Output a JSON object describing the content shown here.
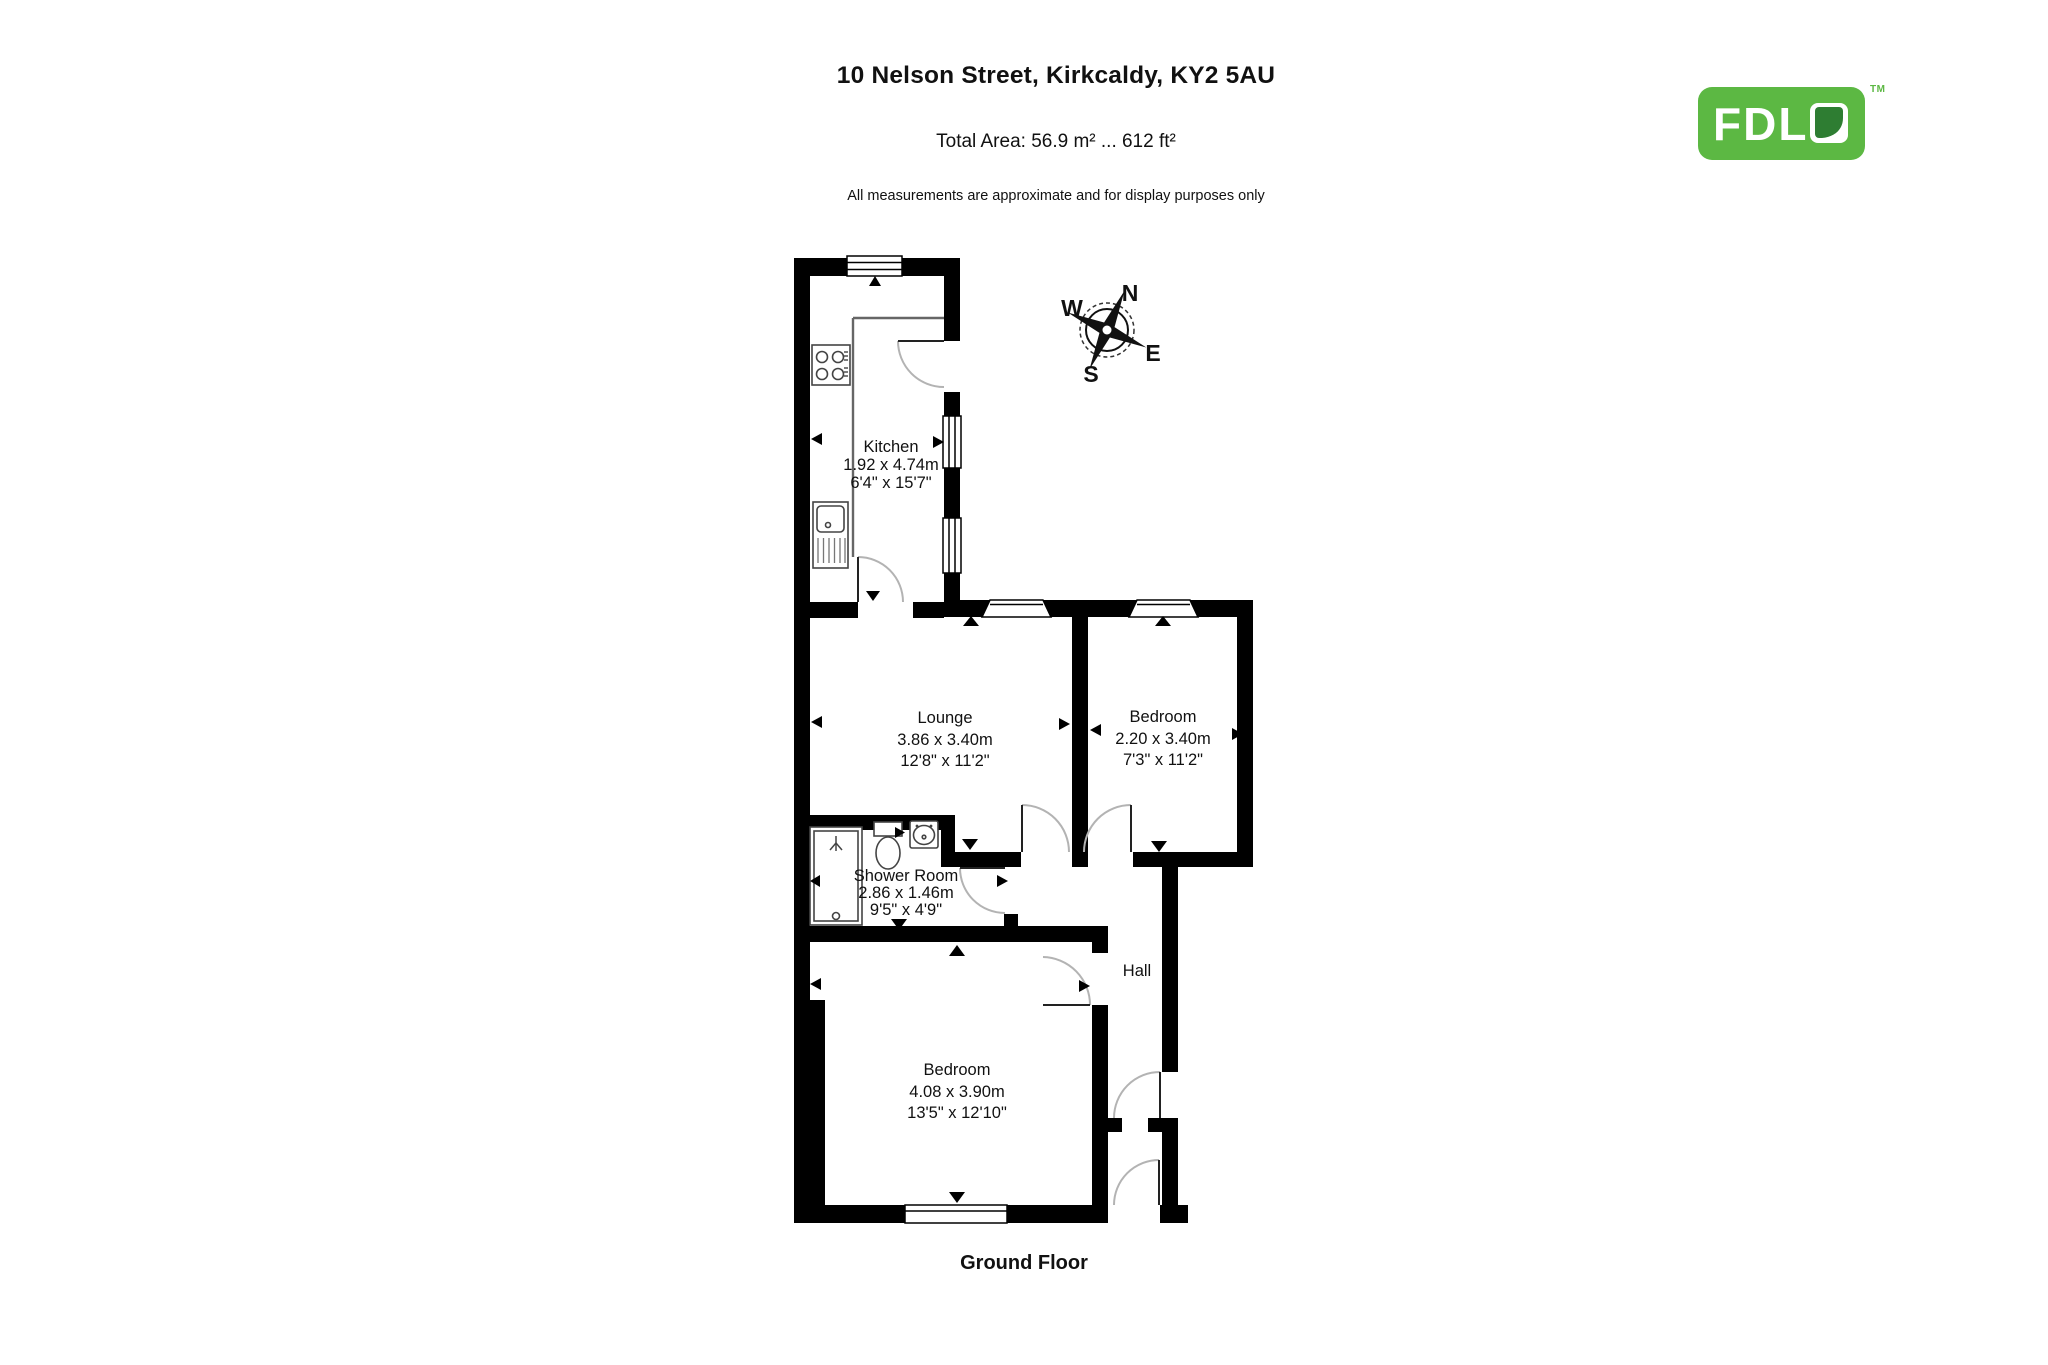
{
  "header": {
    "title": "10 Nelson Street, Kirkcaldy, KY2 5AU",
    "total_area": "Total Area: 56.9 m² ... 612 ft²",
    "disclaimer": "All measurements are approximate and for display purposes only"
  },
  "logo": {
    "text": "FDL",
    "tm": "TM",
    "brand_green": "#5cb843",
    "leaf_green": "#2e7d32"
  },
  "floor": {
    "label": "Ground Floor"
  },
  "compass": {
    "n": "N",
    "e": "E",
    "s": "S",
    "w": "W"
  },
  "rooms": {
    "kitchen": {
      "name": "Kitchen",
      "metric": "1.92 x 4.74m",
      "imperial": "6'4\" x 15'7\""
    },
    "lounge": {
      "name": "Lounge",
      "metric": "3.86 x 3.40m",
      "imperial": "12'8\" x 11'2\""
    },
    "bedroom1": {
      "name": "Bedroom",
      "metric": "2.20 x 3.40m",
      "imperial": "7'3\" x 11'2\""
    },
    "shower": {
      "name": "Shower Room",
      "metric": "2.86 x 1.46m",
      "imperial": "9'5\" x 4'9\""
    },
    "hall": {
      "name": "Hall"
    },
    "bedroom2": {
      "name": "Bedroom",
      "metric": "4.08 x 3.90m",
      "imperial": "13'5\" x 12'10\""
    }
  }
}
